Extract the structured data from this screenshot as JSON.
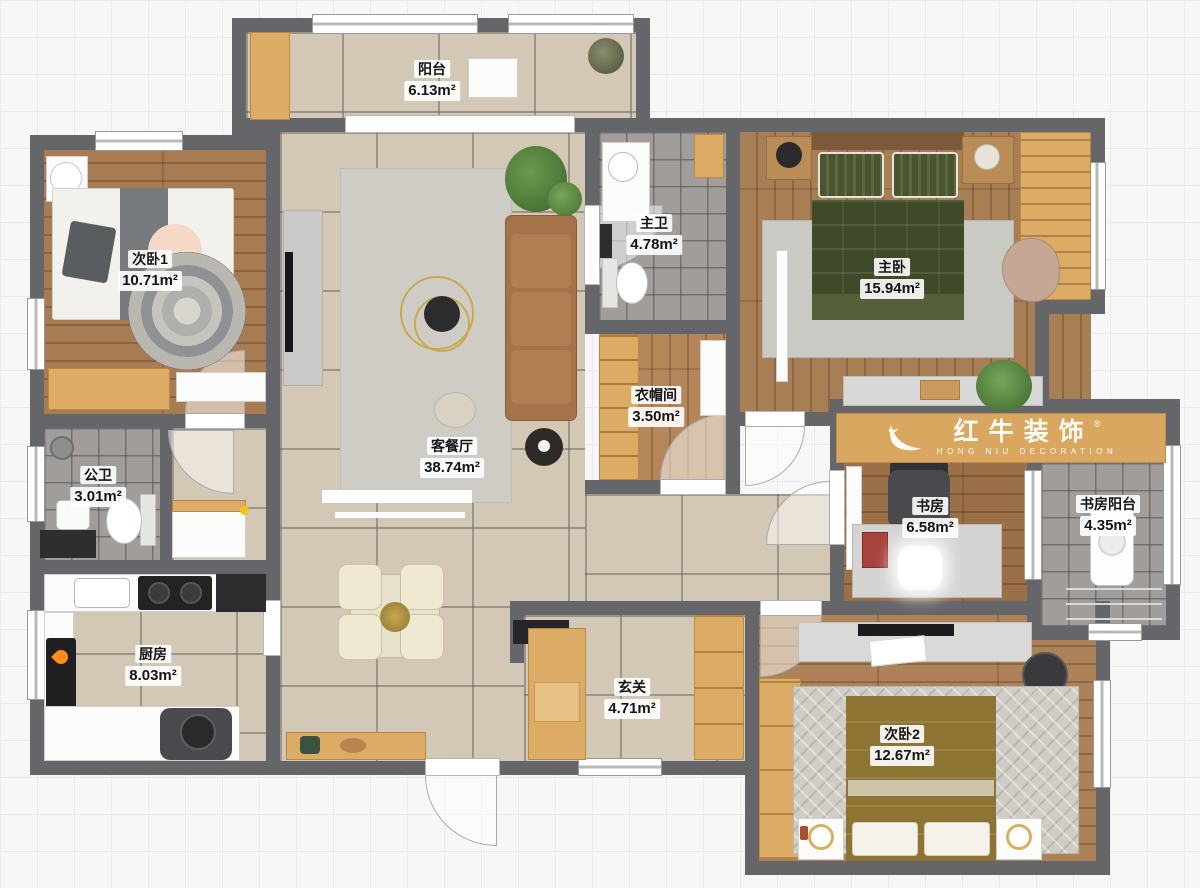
{
  "watermark": {
    "brand": "红牛装饰",
    "sub": "HONG NIU DECORATION",
    "reg": "®"
  },
  "rooms": [
    {
      "id": "balcony",
      "name": "阳台",
      "area": "6.13m²"
    },
    {
      "id": "bedroom1",
      "name": "次卧1",
      "area": "10.71m²"
    },
    {
      "id": "master-bath",
      "name": "主卫",
      "area": "4.78m²"
    },
    {
      "id": "master-bedroom",
      "name": "主卧",
      "area": "15.94m²"
    },
    {
      "id": "closet",
      "name": "衣帽间",
      "area": "3.50m²"
    },
    {
      "id": "living-dining",
      "name": "客餐厅",
      "area": "38.74m²"
    },
    {
      "id": "public-bath",
      "name": "公卫",
      "area": "3.01m²"
    },
    {
      "id": "study",
      "name": "书房",
      "area": "6.58m²"
    },
    {
      "id": "study-balcony",
      "name": "书房阳台",
      "area": "4.35m²"
    },
    {
      "id": "kitchen",
      "name": "厨房",
      "area": "8.03m²"
    },
    {
      "id": "entry",
      "name": "玄关",
      "area": "4.71m²"
    },
    {
      "id": "bedroom2",
      "name": "次卧2",
      "area": "12.67m²"
    }
  ],
  "palette": {
    "wall": "#64666a",
    "tile_beige": "#d3c7b5",
    "tile_gray": "#a09d9a",
    "wood_floor": "#a87c52",
    "cabinet_wood": "#dcab66",
    "sofa": "#a5734a",
    "bed_green": "#3f4a28",
    "bed_gold": "#8d7433",
    "plant": "#55813c",
    "accent_yellow": "#f2c511",
    "watermark_band": "#d9a75f"
  }
}
